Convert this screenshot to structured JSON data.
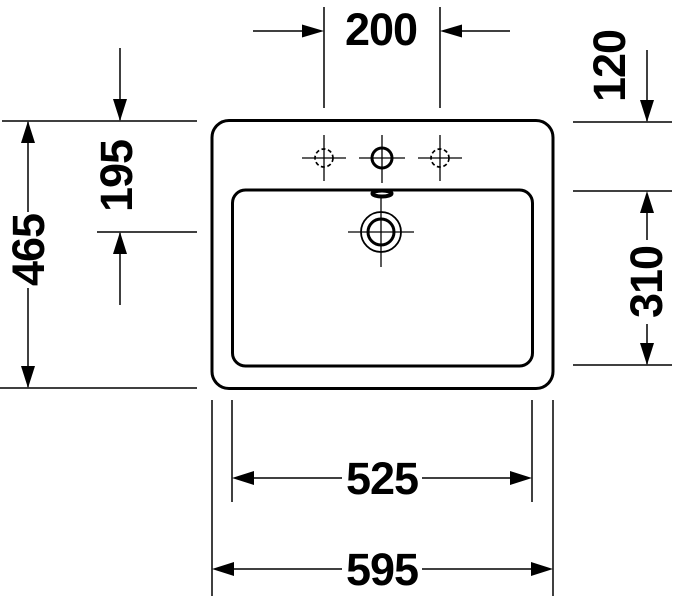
{
  "diagram": {
    "type": "technical-dimension-drawing",
    "subject": "rectangular washbasin, top view, with three tap holes, overflow slot and drain",
    "colors": {
      "line": "#000000",
      "background": "#ffffff"
    },
    "dimensions": {
      "tap_hole_spacing": "200",
      "rim_to_inner_edge": "120",
      "rim_to_drain_center": "195",
      "overall_depth": "465",
      "inner_basin_depth": "310",
      "inner_basin_width": "525",
      "overall_width": "595"
    }
  }
}
